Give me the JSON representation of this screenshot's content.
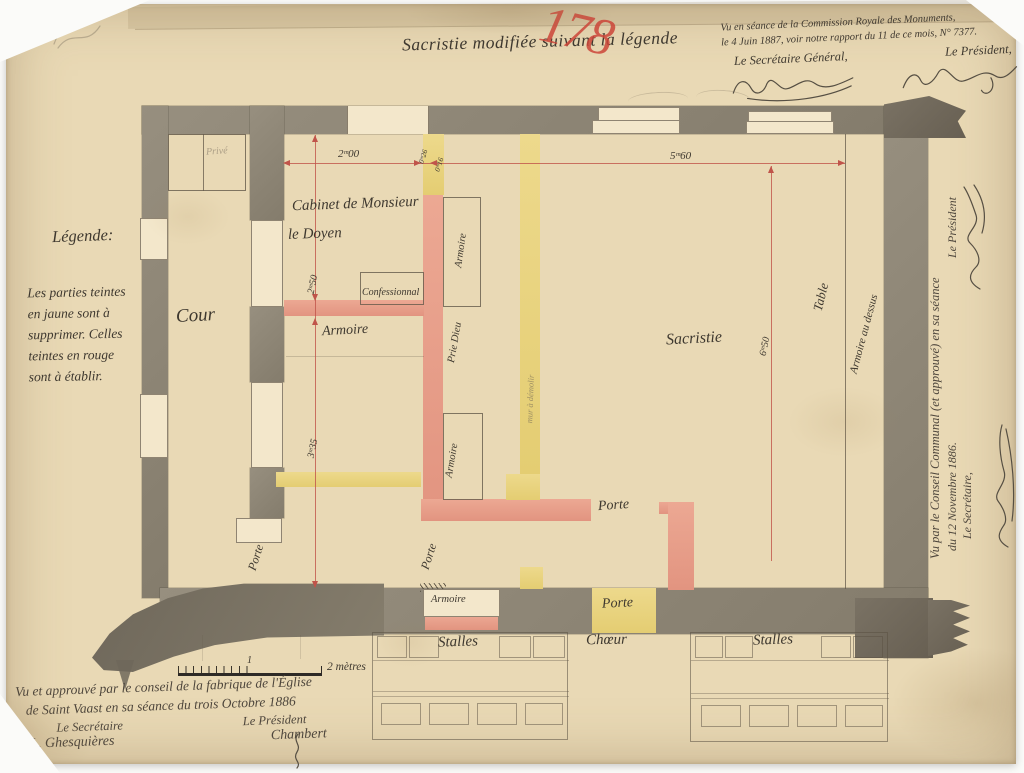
{
  "colors": {
    "paper": "#e9d9b5",
    "paper_light": "#f3e7cb",
    "wall_gray": "#8e8677",
    "wall_dark": "#6f685b",
    "red_new": "#e89a84",
    "yellow_rm": "#e8d27c",
    "dim_red": "#c0544a",
    "ink": "#3e382f",
    "red_crayon": "#cc4639"
  },
  "header": {
    "title": "Sacristie modifiée suivant la légende",
    "red_number": "178",
    "commission_line1": "Vu en séance de la Commission Royale des Monuments,",
    "commission_line2": "le 4 Juin 1887, voir notre rapport du 11 de ce mois, N° 7377.",
    "secretary_general": "Le Secrétaire Général,",
    "president": "Le Président,"
  },
  "legend": {
    "title": "Légende:",
    "body": "Les parties teintes\nen jaune sont à\nsupprimer. Celles\nteintes en rouge\nsont à établir."
  },
  "rooms": {
    "cour": "Cour",
    "prive": "Privé",
    "cabinet_line1": "Cabinet de Monsieur",
    "cabinet_line2": "le Doyen",
    "confessionnal": "Confessionnal",
    "armoire": "Armoire",
    "prie_dieu": "Prie Dieu",
    "mur_a_demolir": "mur à démolir",
    "sacristie": "Sacristie",
    "table": "Table",
    "armoire_au_dessus": "Armoire au dessus",
    "porte": "Porte",
    "stalles": "Stalles",
    "choeur": "Chœur"
  },
  "dimensions": {
    "w_cabinet": "2ᵐ00",
    "w_sacristie": "5ᵐ60",
    "h_cabinet": "2ᵐ50",
    "h_armoire": "3ᵐ35",
    "h_sacristie": "6ᵐ50",
    "t_wall_yellow": "0ᵐ26",
    "t_wall_red": "0ᵐ16"
  },
  "scale": {
    "mid": "1",
    "end": "2 mètres"
  },
  "approval_fabrique": {
    "line1": "Vu et approuvé par le conseil de la fabrique de l'Église",
    "line2": "de Saint Vaast en sa séance du trois Octobre 1886",
    "secretary": "Le Secrétaire",
    "president": "Le Président",
    "secretary_name": "J. L. Ghesquières",
    "president_name": "Chambert"
  },
  "approval_commune": {
    "line1": "Vu par le Conseil Communal (et approuvé) en sa séance",
    "line2": "du 12 Novembre 1886.",
    "secretary": "Le Secrétaire,",
    "president": "Le Président"
  }
}
